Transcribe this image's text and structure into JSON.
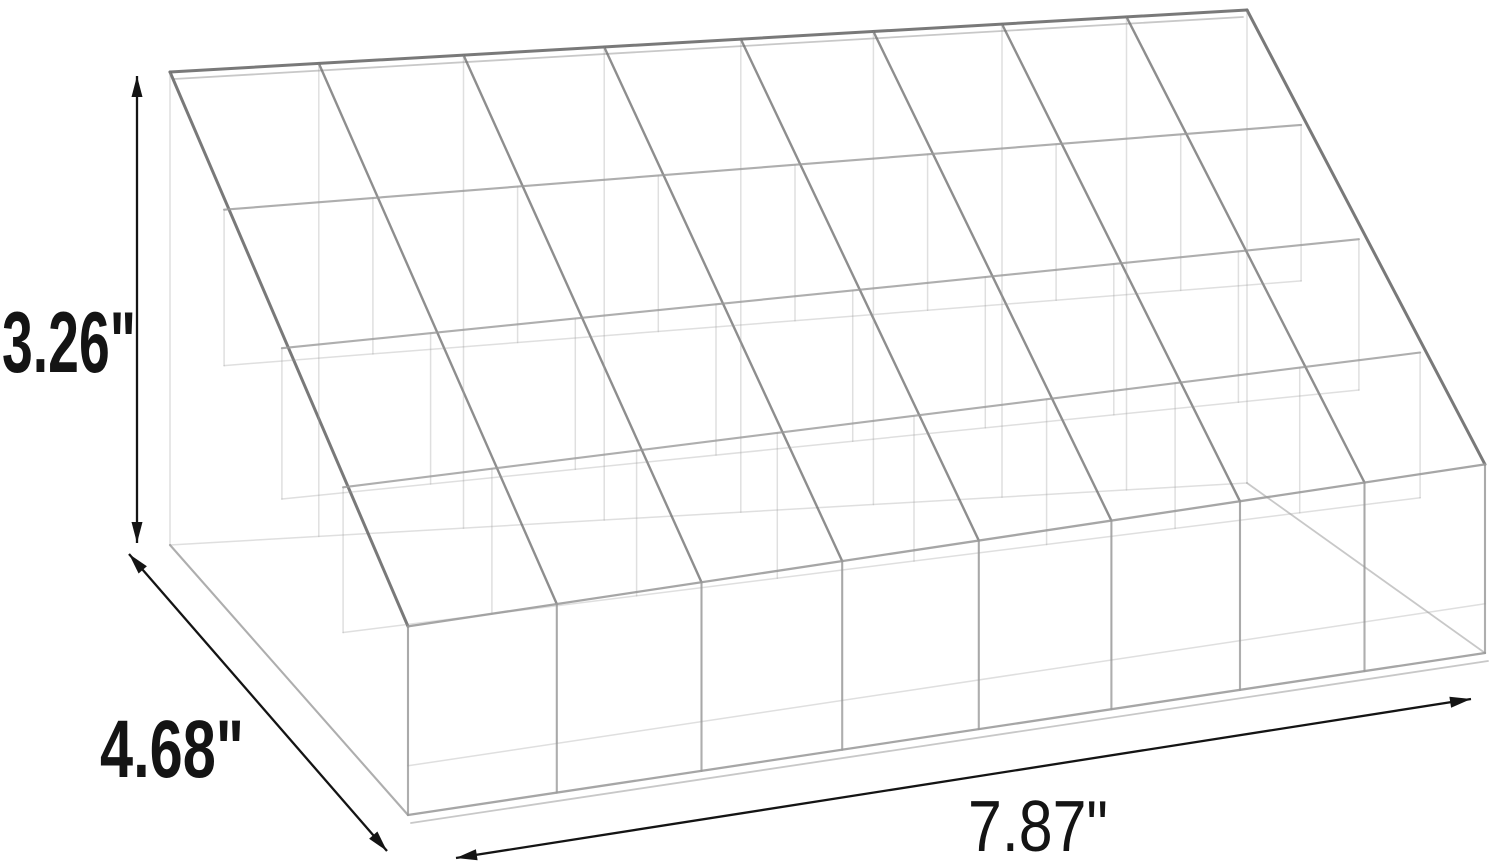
{
  "diagram": {
    "type": "product-dimension-diagram",
    "product": {
      "name": "clear-acrylic-tiered-lipstick-organizer",
      "grid_columns": 8,
      "grid_rows": 4,
      "compartments": 32
    },
    "dimensions": {
      "height": "3.26\"",
      "depth": "4.68\"",
      "width": "7.87\""
    },
    "colors": {
      "background": "#ffffff",
      "line_art": "#9a9a9a",
      "line_art_dark": "#6e6e6e",
      "dimension_ink": "#141414"
    }
  }
}
